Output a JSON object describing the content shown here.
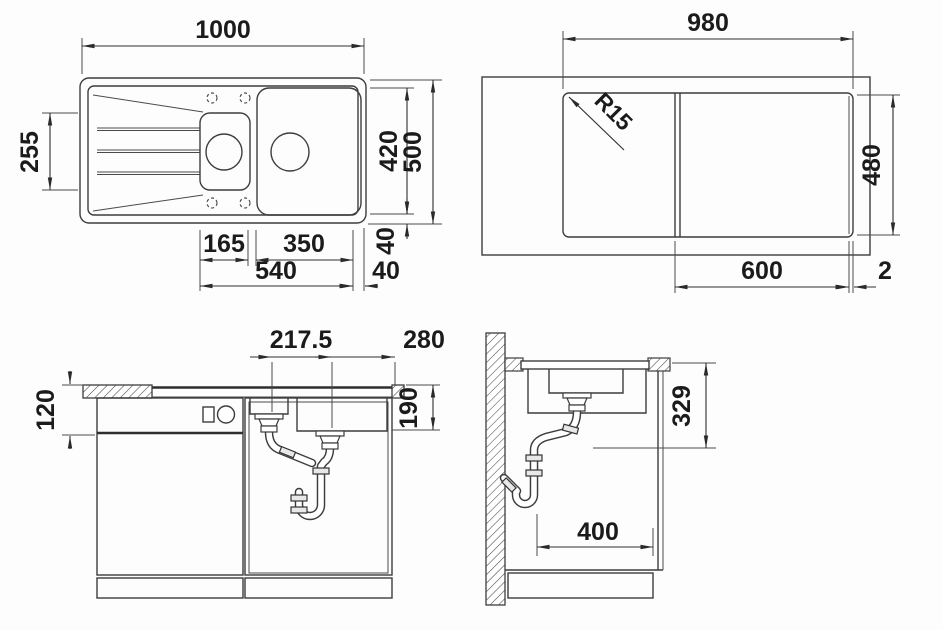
{
  "page": {
    "background": "#fdfdfd",
    "line_color": "#3d3d3d",
    "text_color": "#1b1b1b"
  },
  "views": {
    "top_plan": {
      "dims": {
        "overall_width": "1000",
        "bowl_front_depth": "255",
        "inner_depth": "420",
        "overall_depth": "500",
        "rim_bottom": "40",
        "small_bowl_width": "165",
        "large_bowl_width": "350",
        "bowls_total_width": "540",
        "rim_right": "40"
      }
    },
    "cutout_plan": {
      "dims": {
        "cutout_width": "980",
        "cutout_depth": "480",
        "corner_radius": "R15",
        "bowl_section_width": "600",
        "reveal_gap": "2"
      }
    },
    "front_section": {
      "dims": {
        "apron_height": "120",
        "drain_spacing": "217.5",
        "drain_to_edge": "280",
        "bowl_depth": "190"
      }
    },
    "side_section": {
      "dims": {
        "clearance_below": "329",
        "cabinet_clearance": "400"
      }
    }
  }
}
